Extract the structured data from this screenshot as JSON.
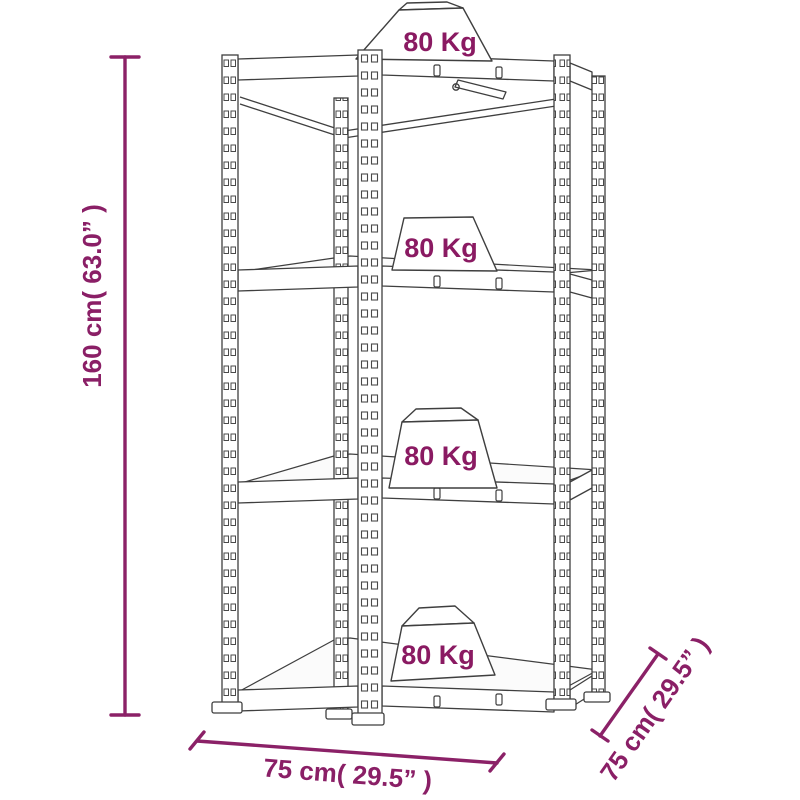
{
  "diagram": {
    "weights": {
      "shelf1": "80 Kg",
      "shelf2": "80 Kg",
      "shelf3": "80 Kg",
      "shelf4": "80 Kg"
    },
    "dimensions": {
      "height": "160 cm( 63.0” )",
      "width": "75 cm( 29.5” )",
      "depth": "75 cm( 29.5” )"
    },
    "colors": {
      "dimension_accent": "#8B2167",
      "weight_label": "#8A1A62",
      "structure_line": "#3F3F3F",
      "background": "#FFFFFF"
    }
  }
}
